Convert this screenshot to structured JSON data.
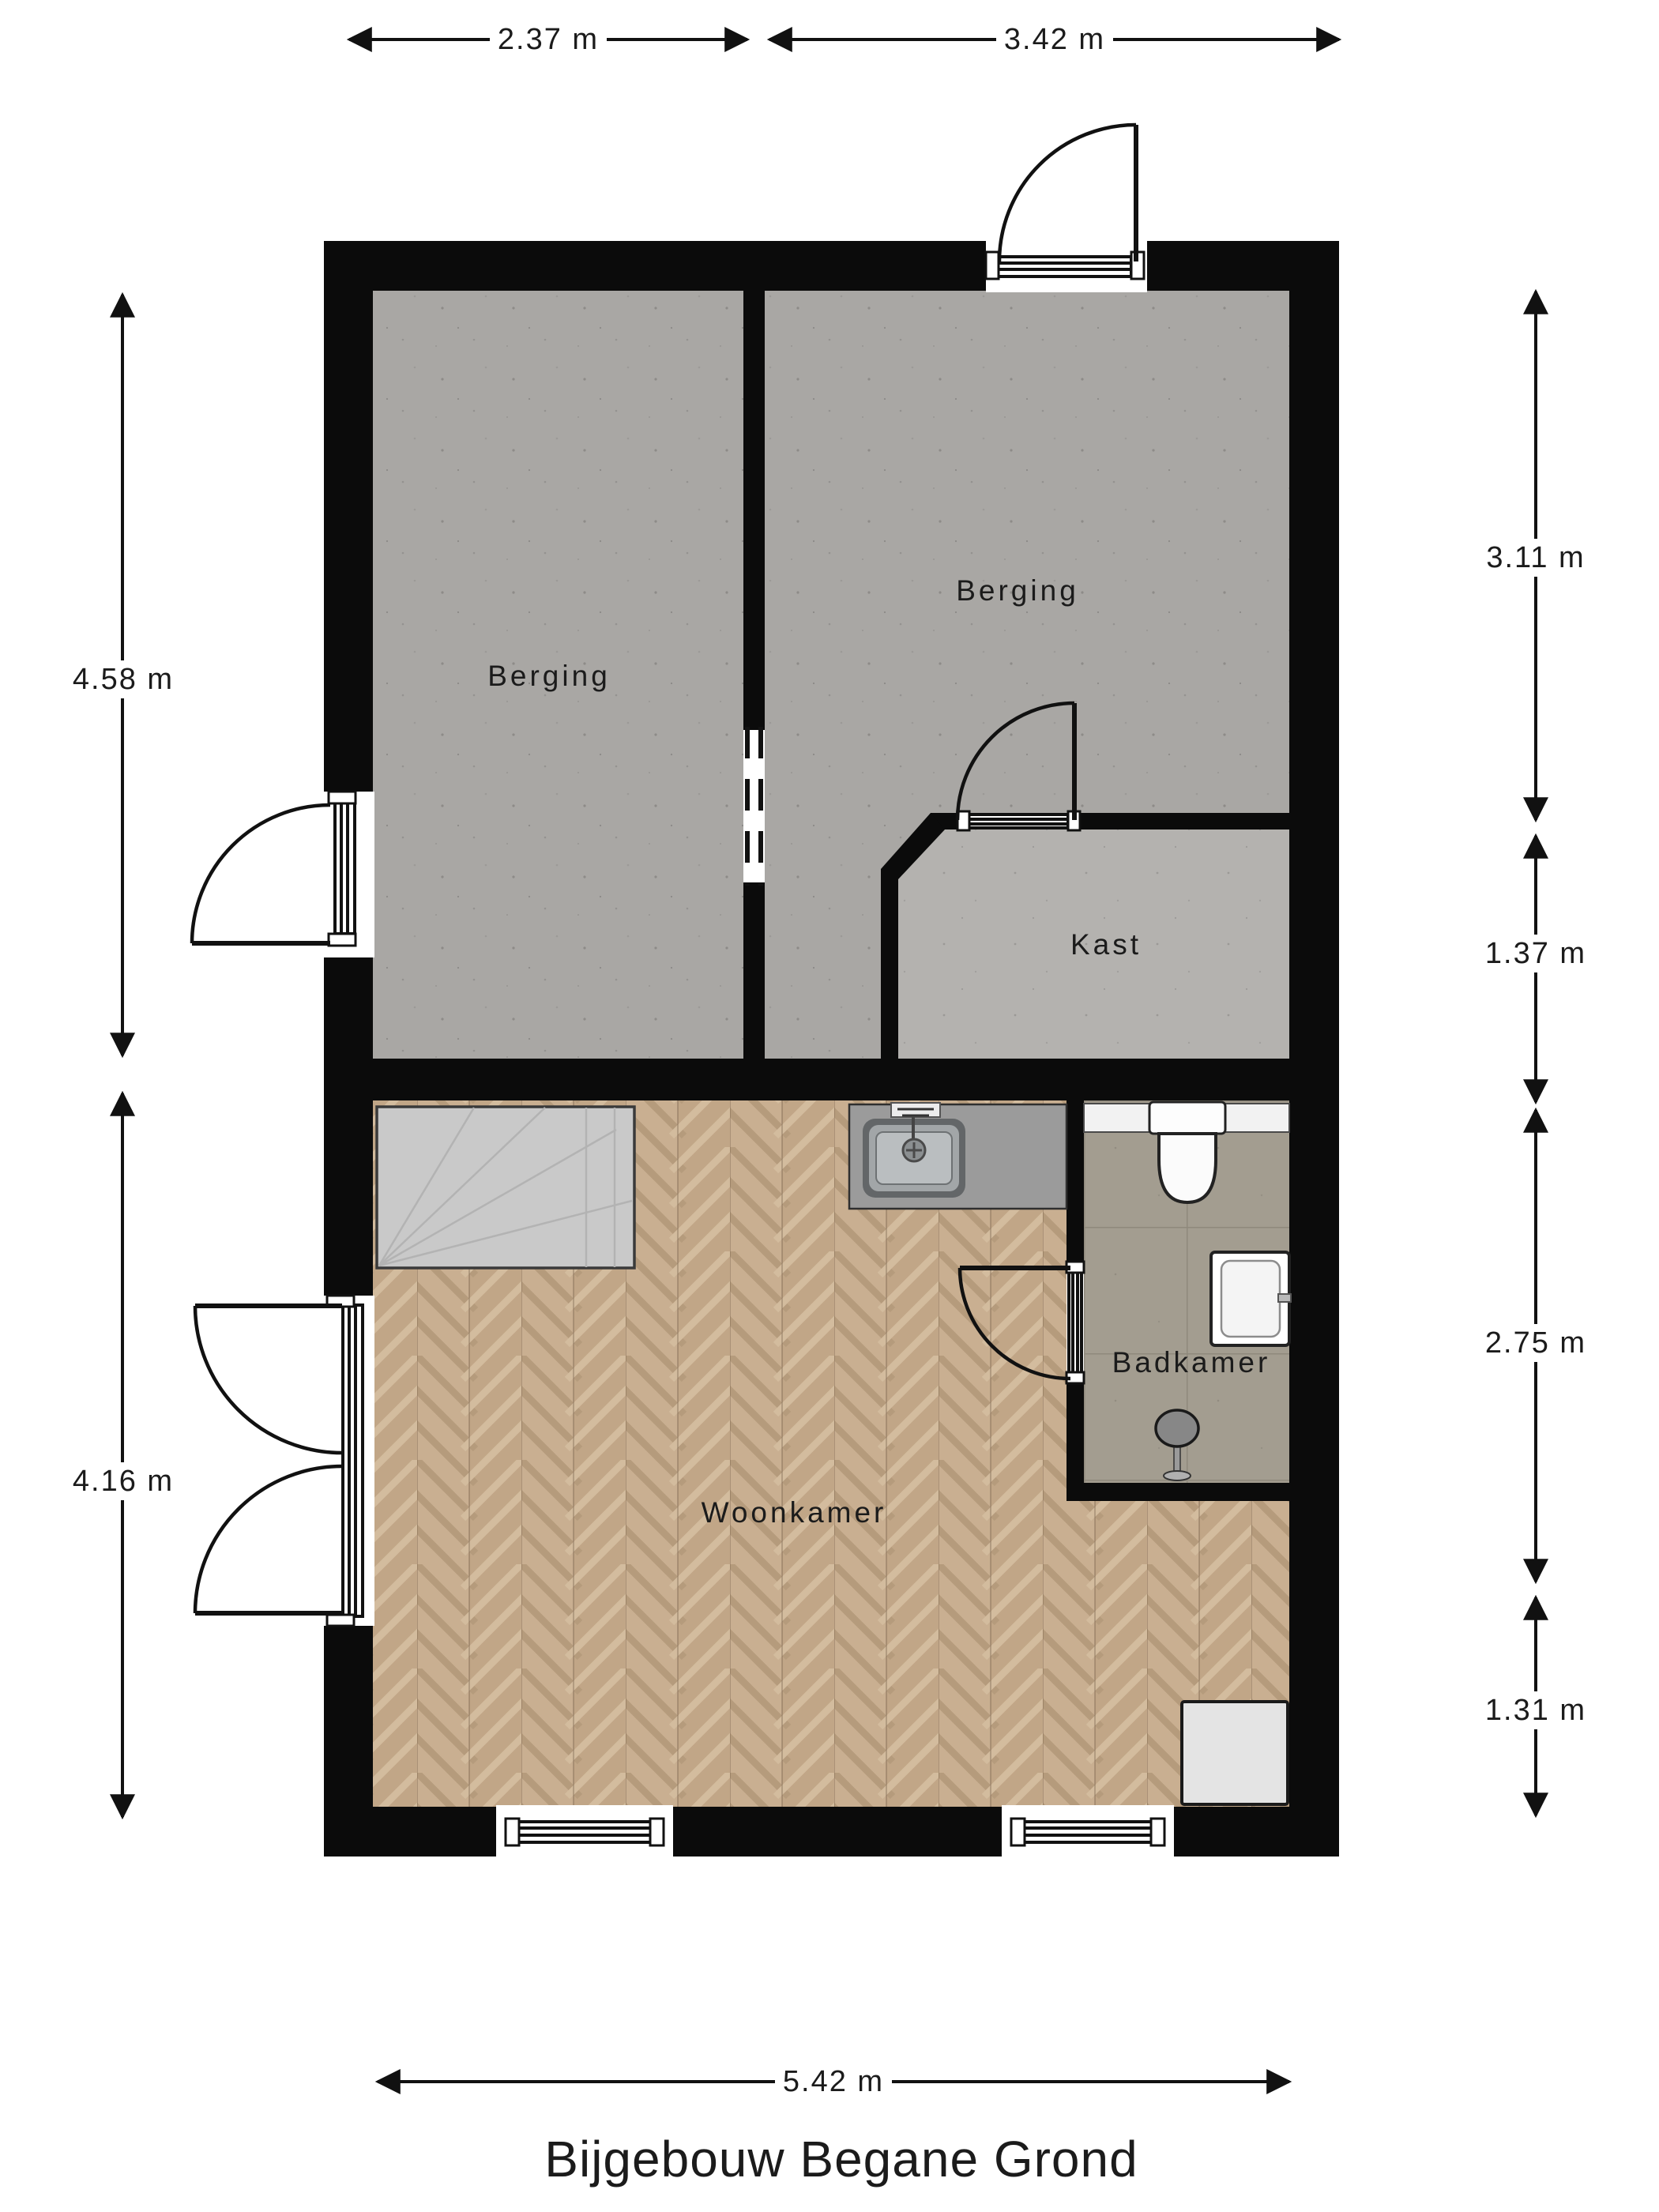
{
  "title": "Bijgebouw Begane Grond",
  "rooms": {
    "berging_left": "Berging",
    "berging_right": "Berging",
    "kast": "Kast",
    "woonkamer": "Woonkamer",
    "badkamer": "Badkamer"
  },
  "dimensions": {
    "top_left_width": "2.37 m",
    "top_right_width": "3.42 m",
    "left_upper_height": "4.58 m",
    "left_lower_height": "4.16 m",
    "right_berging_height": "3.11 m",
    "right_kast_height": "1.37 m",
    "right_badkamer_height": "2.75 m",
    "right_lower_height": "1.31 m",
    "bottom_width": "5.42 m"
  },
  "colors": {
    "wall": "#0b0b0b",
    "berging_floor": "#a9a7a4",
    "kast_floor": "#b4b2af",
    "wood_light": "#c9af91",
    "wood_dark": "#c1a687",
    "tile_floor": "#a39d90",
    "counter": "#9b9b9b",
    "stairs": "#c9c9c9"
  }
}
